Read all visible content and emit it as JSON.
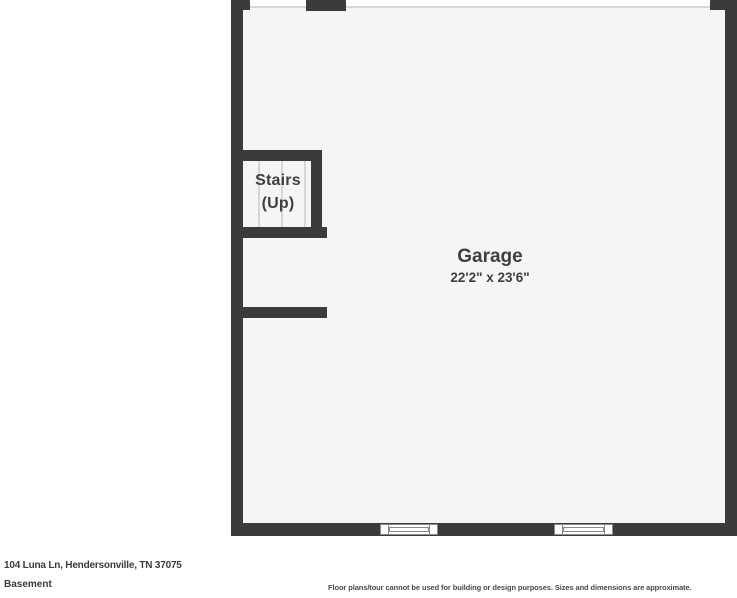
{
  "floorplan": {
    "room": {
      "name": "Garage",
      "dimensions": "22'2\" x 23'6\""
    },
    "stairs": {
      "line1": "Stairs",
      "line2": "(Up)"
    },
    "colors": {
      "wall": "#3b3b3b",
      "floor": "#f5f5f5",
      "label_text": "#3f3f3f"
    }
  },
  "footer": {
    "address": "104 Luna Ln, Hendersonville, TN 37075",
    "level": "Basement",
    "disclaimer": "Floor plans/tour cannot be used for building or design purposes. Sizes and dimensions are approximate."
  }
}
